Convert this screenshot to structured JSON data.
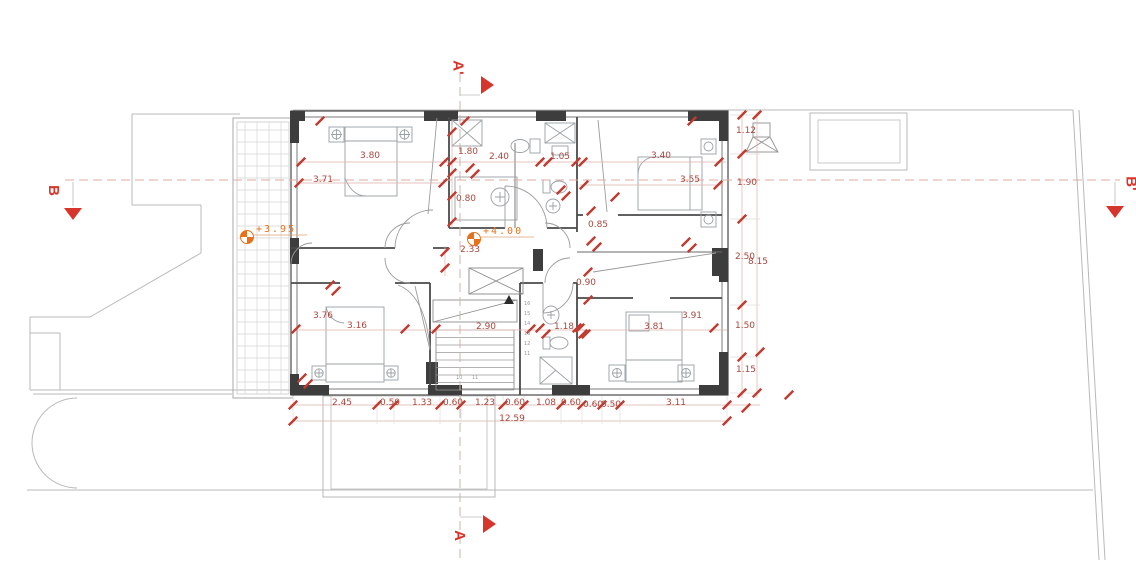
{
  "drawing_type": "first-floor architectural plan",
  "sections": {
    "a_prime": "A'",
    "a": "A",
    "b": "B",
    "b_prime": "B'"
  },
  "levels": [
    {
      "label": "+3.95",
      "x": 247,
      "y": 237
    },
    {
      "label": "+4.00",
      "x": 474,
      "y": 239
    }
  ],
  "dimensions": [
    {
      "label": "3.80",
      "x": 370,
      "y": 152
    },
    {
      "label": "3.71",
      "x": 323,
      "y": 176
    },
    {
      "label": "1.80",
      "x": 468,
      "y": 148
    },
    {
      "label": "2.40",
      "x": 499,
      "y": 153
    },
    {
      "label": "1.05",
      "x": 560,
      "y": 153
    },
    {
      "label": "3.40",
      "x": 661,
      "y": 152
    },
    {
      "label": "3.55",
      "x": 690,
      "y": 176
    },
    {
      "label": "0.80",
      "x": 466,
      "y": 195
    },
    {
      "label": "0.85",
      "x": 598,
      "y": 221
    },
    {
      "label": "2.33",
      "x": 470,
      "y": 246
    },
    {
      "label": "0.90",
      "x": 586,
      "y": 279
    },
    {
      "label": "1.18",
      "x": 564,
      "y": 323
    },
    {
      "label": "2.90",
      "x": 486,
      "y": 323
    },
    {
      "label": "3.16",
      "x": 357,
      "y": 322
    },
    {
      "label": "3.76",
      "x": 323,
      "y": 312
    },
    {
      "label": "3.81",
      "x": 654,
      "y": 323
    },
    {
      "label": "3.91",
      "x": 692,
      "y": 312
    },
    {
      "label": "1.12",
      "x": 746,
      "y": 127
    },
    {
      "label": "1.90",
      "x": 747,
      "y": 179
    },
    {
      "label": "2.50",
      "x": 745,
      "y": 253
    },
    {
      "label": "8.15",
      "x": 758,
      "y": 258
    },
    {
      "label": "1.50",
      "x": 745,
      "y": 322
    },
    {
      "label": "1.15",
      "x": 746,
      "y": 366
    },
    {
      "label": "2.45",
      "x": 342,
      "y": 399
    },
    {
      "label": "0.50",
      "x": 390,
      "y": 399
    },
    {
      "label": "1.33",
      "x": 422,
      "y": 399
    },
    {
      "label": "0.60",
      "x": 453,
      "y": 399
    },
    {
      "label": "1.23",
      "x": 485,
      "y": 399
    },
    {
      "label": "0.60",
      "x": 515,
      "y": 399
    },
    {
      "label": "1.08",
      "x": 546,
      "y": 399
    },
    {
      "label": "0.60",
      "x": 571,
      "y": 399
    },
    {
      "label": "0.60",
      "x": 593,
      "y": 401
    },
    {
      "label": "0.50",
      "x": 611,
      "y": 401
    },
    {
      "label": "3.11",
      "x": 676,
      "y": 399
    },
    {
      "label": "12.59",
      "x": 512,
      "y": 415
    }
  ],
  "stairs": {
    "column_numbers": [
      "16",
      "15",
      "14",
      "13",
      "12",
      "11"
    ],
    "bottom_numbers": [
      "10",
      "11"
    ]
  },
  "colors": {
    "dimension_red": "#a9473e",
    "tick_red": "#c13b30",
    "section_red": "#d6352b",
    "level_orange": "#e8721c",
    "wall_dark": "#3d3d3d",
    "site_gray": "#b9b9b9"
  }
}
